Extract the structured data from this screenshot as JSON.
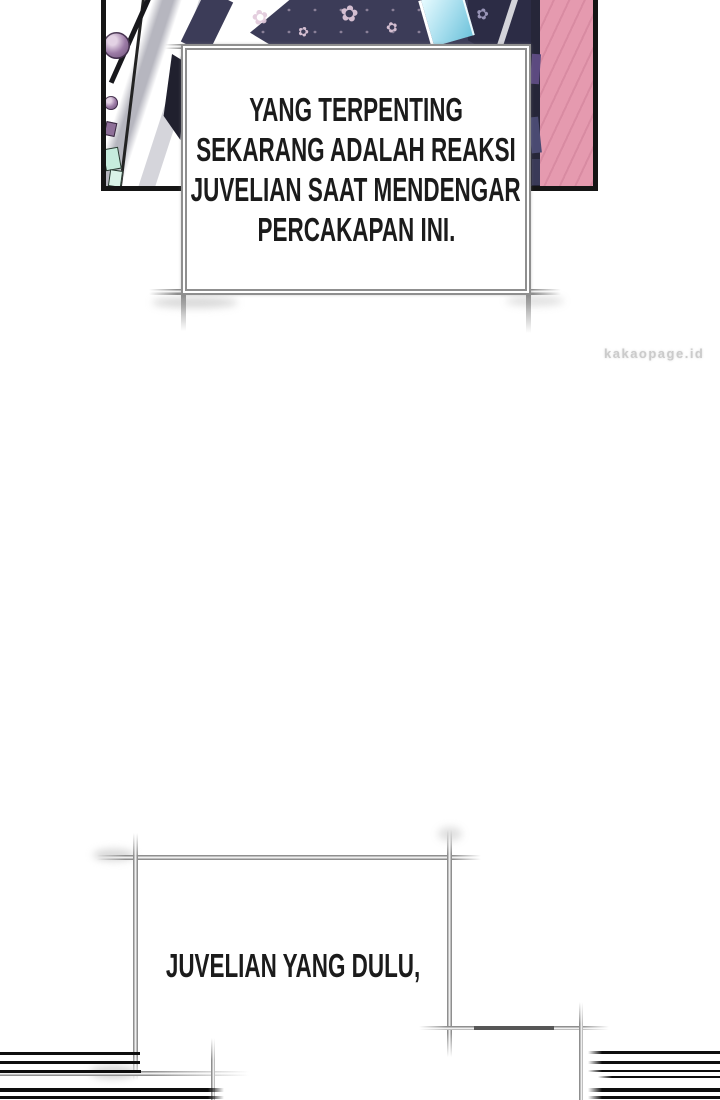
{
  "watermark": {
    "text": "kakaopage.id"
  },
  "narration_box_1": {
    "lines": [
      "YANG TERPENTING",
      "SEKARANG ADALAH REAKSI",
      "JUVELIAN SAAT MENDENGAR",
      "PERCAKAPAN INI."
    ]
  },
  "narration_box_2": {
    "text": "JUVELIAN YANG DULU,"
  },
  "decor": {
    "flower_glyph": "✿"
  },
  "colors": {
    "panel-border": "#151515",
    "fabric-navy": "#3c3c58",
    "fabric-navy-dark": "#2c2c45",
    "pink": "#e59aaf",
    "pink-stroke": "#cf7f99",
    "bead-purple": "#9c7ba6",
    "shard-blue": "#a5dded",
    "streak-gray": "#b6b6bf",
    "teal": "#c6ecdd",
    "box-border": "#8f8f8f",
    "ink": "#1b1b1b",
    "watermark-gray": "#cbcbcb",
    "speedline": "#0e0e0e"
  }
}
